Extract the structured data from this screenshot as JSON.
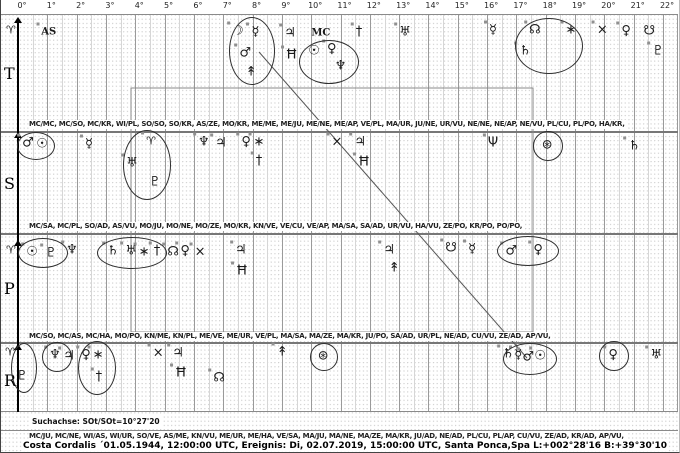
{
  "search_axis": "Suchachse:  SOt/SOt=10°27'20",
  "footer": "Costa Cordalis  ´01.05.1944, 12:00:00 UTC, Ereignis: Di, 02.07.2019, 15:00:00 UTC, Santa Ponca,Spa L:+002°28'16 B:+39°30'10",
  "contact_lines": {
    "row1": "MC/MC, MC/SO, MC/KR, WI/PL, SO/SO, SO/KR, AS/ZE, MO/KR, ME/ME, ME/JU, ME/NE, ME/AP, VE/PL, MA/UR, JU/NE, UR/VU, NE/NE, NE/AP, NE/VU, PL/CU, PL/PO, HA/KR,",
    "row2": "MC/SA, MC/PL, SO/AD, AS/VU, MO/JU, MO/NE, MO/ZE, MO/KR, KN/VE, VE/CU, VE/AP, MA/SA, SA/AD, UR/VU, HA/VU, ZE/PO, KR/PO, PO/PO,",
    "row3": "MC/SO, MC/AS, MC/HA, MO/PO, KN/ME, KN/PL, ME/VE, ME/UR, VE/PL, MA/SA, MA/ZE, MA/KR, JU/PO, SA/AD, UR/PL, NE/AD, CU/VU, ZE/AD, AP/VU,",
    "row4": "MC/JU, MC/NE, WI/AS, WI/UR, SO/VE, AS/ME, KN/VU, ME/UR, ME/HA, VE/SA, MA/JU, MA/NE, MA/ZE, MA/KR, JU/AD, NE/AD, PL/CU, PL/AP, CU/VU, ZE/AD, KR/AD, AP/VU,",
    "note": ""
  },
  "chart_data": {
    "type": "scatter",
    "title": "Uranian astrology 22.5° sort dial, four stacked rows (T transit / S / P / R radix) with planet positions in dial degrees",
    "xlabel": "dial degrees",
    "x_axis": {
      "range": [
        0,
        22.5
      ],
      "ticks": [
        "0°",
        "1°",
        "2°",
        "3°",
        "4°",
        "5°",
        "6°",
        "7°",
        "8°",
        "9°",
        "10°",
        "11°",
        "12°",
        "13°",
        "14°",
        "15°",
        "16°",
        "17°",
        "18°",
        "19°",
        "20°",
        "21°",
        "22°"
      ]
    },
    "glyph_map": {
      "aries": "♈",
      "AS": "AS",
      "MC": "MC",
      "sun": "☉",
      "moon": "☽",
      "mercury": "☿",
      "venus": "♀",
      "mars": "♂",
      "jupiter": "♃",
      "saturn": "♄",
      "uranus": "♅",
      "neptune": "♆",
      "pluto": "♇",
      "node": "☊",
      "zeus": "↟",
      "kronos": "†",
      "apollon": "∗",
      "vulkanus": "×",
      "admetos": "Ħ",
      "cupido": "☿",
      "hades": "Ψ",
      "poseidon": "⊛",
      "lilith": "☋"
    },
    "rows": [
      {
        "label": "T",
        "points": [
          {
            "g": "aries",
            "d": -0.24,
            "dy": -2
          },
          {
            "g": "AS",
            "d": 1.05,
            "dy": 0,
            "m": true
          },
          {
            "g": "moon",
            "d": 7.5,
            "dy": -1,
            "m": true
          },
          {
            "g": "cupido",
            "d": 8.1,
            "dy": 0,
            "m": true
          },
          {
            "g": "mars",
            "d": 7.75,
            "dy": 21,
            "m": true
          },
          {
            "g": "zeus",
            "d": 7.95,
            "dy": 40
          },
          {
            "g": "jupiter",
            "d": 9.28,
            "dy": 1,
            "m": true
          },
          {
            "g": "admetos",
            "d": 9.33,
            "dy": 23,
            "m": true
          },
          {
            "g": "MC",
            "d": 10.33,
            "dy": 1
          },
          {
            "g": "sun",
            "d": 10.1,
            "dy": 19
          },
          {
            "g": "venus",
            "d": 10.7,
            "dy": 17,
            "m": true
          },
          {
            "g": "neptune",
            "d": 11.0,
            "dy": 34
          },
          {
            "g": "kronos",
            "d": 11.63,
            "dy": 0,
            "m": true
          },
          {
            "g": "uranus",
            "d": 13.2,
            "dy": 0,
            "m": true
          },
          {
            "g": "mercury",
            "d": 16.2,
            "dy": -2,
            "m": true
          },
          {
            "g": "saturn",
            "d": 17.3,
            "dy": 19,
            "m": true
          },
          {
            "g": "node",
            "d": 17.63,
            "dy": -2,
            "m": true
          },
          {
            "g": "apollon",
            "d": 18.86,
            "dy": -2,
            "m": true
          },
          {
            "g": "vulkanus",
            "d": 19.93,
            "dy": -2,
            "m": true
          },
          {
            "g": "venus",
            "d": 20.74,
            "dy": -1,
            "m": true
          },
          {
            "g": "lilith",
            "d": 21.53,
            "dy": -1
          },
          {
            "g": "pluto",
            "d": 21.83,
            "dy": 19,
            "m": true
          }
        ]
      },
      {
        "label": "S",
        "points": [
          {
            "g": "mars",
            "d": 0.34,
            "dy": -1,
            "m": true
          },
          {
            "g": "sun",
            "d": 0.82,
            "dy": 0
          },
          {
            "g": "mercury",
            "d": 2.42,
            "dy": 0,
            "m": true
          },
          {
            "g": "aries",
            "d": 4.54,
            "dy": -3,
            "m": true
          },
          {
            "g": "uranus",
            "d": 3.89,
            "dy": 19,
            "m": true
          },
          {
            "g": "pluto",
            "d": 4.67,
            "dy": 38
          },
          {
            "g": "neptune",
            "d": 6.34,
            "dy": -2,
            "m": true
          },
          {
            "g": "jupiter",
            "d": 6.92,
            "dy": -1,
            "m": true
          },
          {
            "g": "venus",
            "d": 7.78,
            "dy": -2,
            "m": true
          },
          {
            "g": "apollon",
            "d": 8.22,
            "dy": -2,
            "m": true
          },
          {
            "g": "kronos",
            "d": 8.22,
            "dy": 17,
            "m": true
          },
          {
            "g": "vulkanus",
            "d": 10.88,
            "dy": -2,
            "m": true
          },
          {
            "g": "jupiter",
            "d": 11.67,
            "dy": -2,
            "m": true
          },
          {
            "g": "admetos",
            "d": 11.8,
            "dy": 18,
            "m": true
          },
          {
            "g": "hades",
            "d": 16.2,
            "dy": -1,
            "m": true
          },
          {
            "g": "poseidon",
            "d": 18.05,
            "dy": 1
          },
          {
            "g": "saturn",
            "d": 21.02,
            "dy": 2,
            "m": true
          }
        ]
      },
      {
        "label": "P",
        "points": [
          {
            "g": "aries",
            "d": -0.24,
            "dy": -1
          },
          {
            "g": "sun",
            "d": 0.48,
            "dy": 1,
            "m": true
          },
          {
            "g": "pluto",
            "d": 1.13,
            "dy": 2,
            "m": true
          },
          {
            "g": "neptune",
            "d": 1.84,
            "dy": -1,
            "m": true
          },
          {
            "g": "saturn",
            "d": 3.24,
            "dy": 0,
            "m": true
          },
          {
            "g": "uranus",
            "d": 3.86,
            "dy": 0,
            "m": true
          },
          {
            "g": "apollon",
            "d": 4.3,
            "dy": 1,
            "m": true
          },
          {
            "g": "kronos",
            "d": 4.74,
            "dy": 0,
            "m": true
          },
          {
            "g": "node",
            "d": 5.29,
            "dy": 1,
            "m": true
          },
          {
            "g": "venus",
            "d": 5.7,
            "dy": 0,
            "m": true
          },
          {
            "g": "vulkanus",
            "d": 6.21,
            "dy": 1,
            "m": true
          },
          {
            "g": "jupiter",
            "d": 7.6,
            "dy": -1,
            "m": true
          },
          {
            "g": "admetos",
            "d": 7.64,
            "dy": 20,
            "m": true
          },
          {
            "g": "jupiter",
            "d": 12.66,
            "dy": -1,
            "m": true
          },
          {
            "g": "zeus",
            "d": 12.83,
            "dy": 17
          },
          {
            "g": "lilith",
            "d": 14.77,
            "dy": -3,
            "m": true
          },
          {
            "g": "mercury",
            "d": 15.49,
            "dy": -2,
            "m": true
          },
          {
            "g": "mars",
            "d": 16.82,
            "dy": 0,
            "m": true
          },
          {
            "g": "venus",
            "d": 17.74,
            "dy": -1,
            "m": true
          }
        ]
      },
      {
        "label": "R",
        "points": [
          {
            "g": "aries",
            "d": -0.27,
            "dy": -3
          },
          {
            "g": "pluto",
            "d": 0.14,
            "dy": 21
          },
          {
            "g": "neptune",
            "d": 1.26,
            "dy": 0,
            "m": true
          },
          {
            "g": "jupiter",
            "d": 1.74,
            "dy": 1,
            "m": true
          },
          {
            "g": "venus",
            "d": 2.32,
            "dy": 0,
            "m": true
          },
          {
            "g": "apollon",
            "d": 2.73,
            "dy": 0,
            "m": true
          },
          {
            "g": "kronos",
            "d": 2.76,
            "dy": 22,
            "m": true
          },
          {
            "g": "vulkanus",
            "d": 4.78,
            "dy": -2,
            "m": true
          },
          {
            "g": "jupiter",
            "d": 5.46,
            "dy": -2,
            "m": true
          },
          {
            "g": "admetos",
            "d": 5.56,
            "dy": 18,
            "m": true
          },
          {
            "g": "node",
            "d": 6.86,
            "dy": 23,
            "m": true
          },
          {
            "g": "zeus",
            "d": 9.01,
            "dy": -3,
            "m": true
          },
          {
            "g": "poseidon",
            "d": 10.41,
            "dy": 1
          },
          {
            "g": "saturn",
            "d": 16.72,
            "dy": -1,
            "m": true
          },
          {
            "g": "mercury",
            "d": 17.06,
            "dy": 0,
            "m": true
          },
          {
            "g": "mars",
            "d": 17.4,
            "dy": 2,
            "m": true
          },
          {
            "g": "sun",
            "d": 17.81,
            "dy": 1,
            "m": true
          },
          {
            "g": "venus",
            "d": 20.3,
            "dy": 0,
            "m": true
          },
          {
            "g": "uranus",
            "d": 21.77,
            "dy": 0,
            "m": true
          }
        ]
      }
    ],
    "annotations": {
      "ellipses": [
        {
          "cx": 250,
          "cy": 50,
          "rx": 22,
          "ry": 33
        },
        {
          "cx": 327,
          "cy": 61,
          "rx": 29,
          "ry": 21
        },
        {
          "cx": 547,
          "cy": 45,
          "rx": 33,
          "ry": 27
        },
        {
          "cx": 34,
          "cy": 145,
          "rx": 18,
          "ry": 13
        },
        {
          "cx": 145,
          "cy": 164,
          "rx": 23,
          "ry": 34
        },
        {
          "cx": 546,
          "cy": 145,
          "rx": 14,
          "ry": 14
        },
        {
          "cx": 41,
          "cy": 252,
          "rx": 24,
          "ry": 14
        },
        {
          "cx": 130,
          "cy": 252,
          "rx": 34,
          "ry": 15
        },
        {
          "cx": 526,
          "cy": 250,
          "rx": 30,
          "ry": 14
        },
        {
          "cx": 22,
          "cy": 367,
          "rx": 12,
          "ry": 24
        },
        {
          "cx": 55,
          "cy": 356,
          "rx": 14,
          "ry": 14
        },
        {
          "cx": 95,
          "cy": 367,
          "rx": 18,
          "ry": 26
        },
        {
          "cx": 322,
          "cy": 356,
          "rx": 13,
          "ry": 13
        },
        {
          "cx": 528,
          "cy": 358,
          "rx": 26,
          "ry": 15
        },
        {
          "cx": 612,
          "cy": 355,
          "rx": 14,
          "ry": 14
        }
      ],
      "diagonal": {
        "x1": 258,
        "y1": 52,
        "x2": 526,
        "y2": 358
      },
      "frame": {
        "x": 130,
        "y": 88,
        "w": 402,
        "h": 244
      }
    },
    "colors": {
      "grid_line": "#9a9a9a",
      "grid_half": "#d6d6d6",
      "grid_dots": "#cecece",
      "separator": "#777777",
      "axis": "#000000",
      "annotation": "#2e2e2e",
      "diagonal": "#555555",
      "frame": "#888888"
    }
  }
}
